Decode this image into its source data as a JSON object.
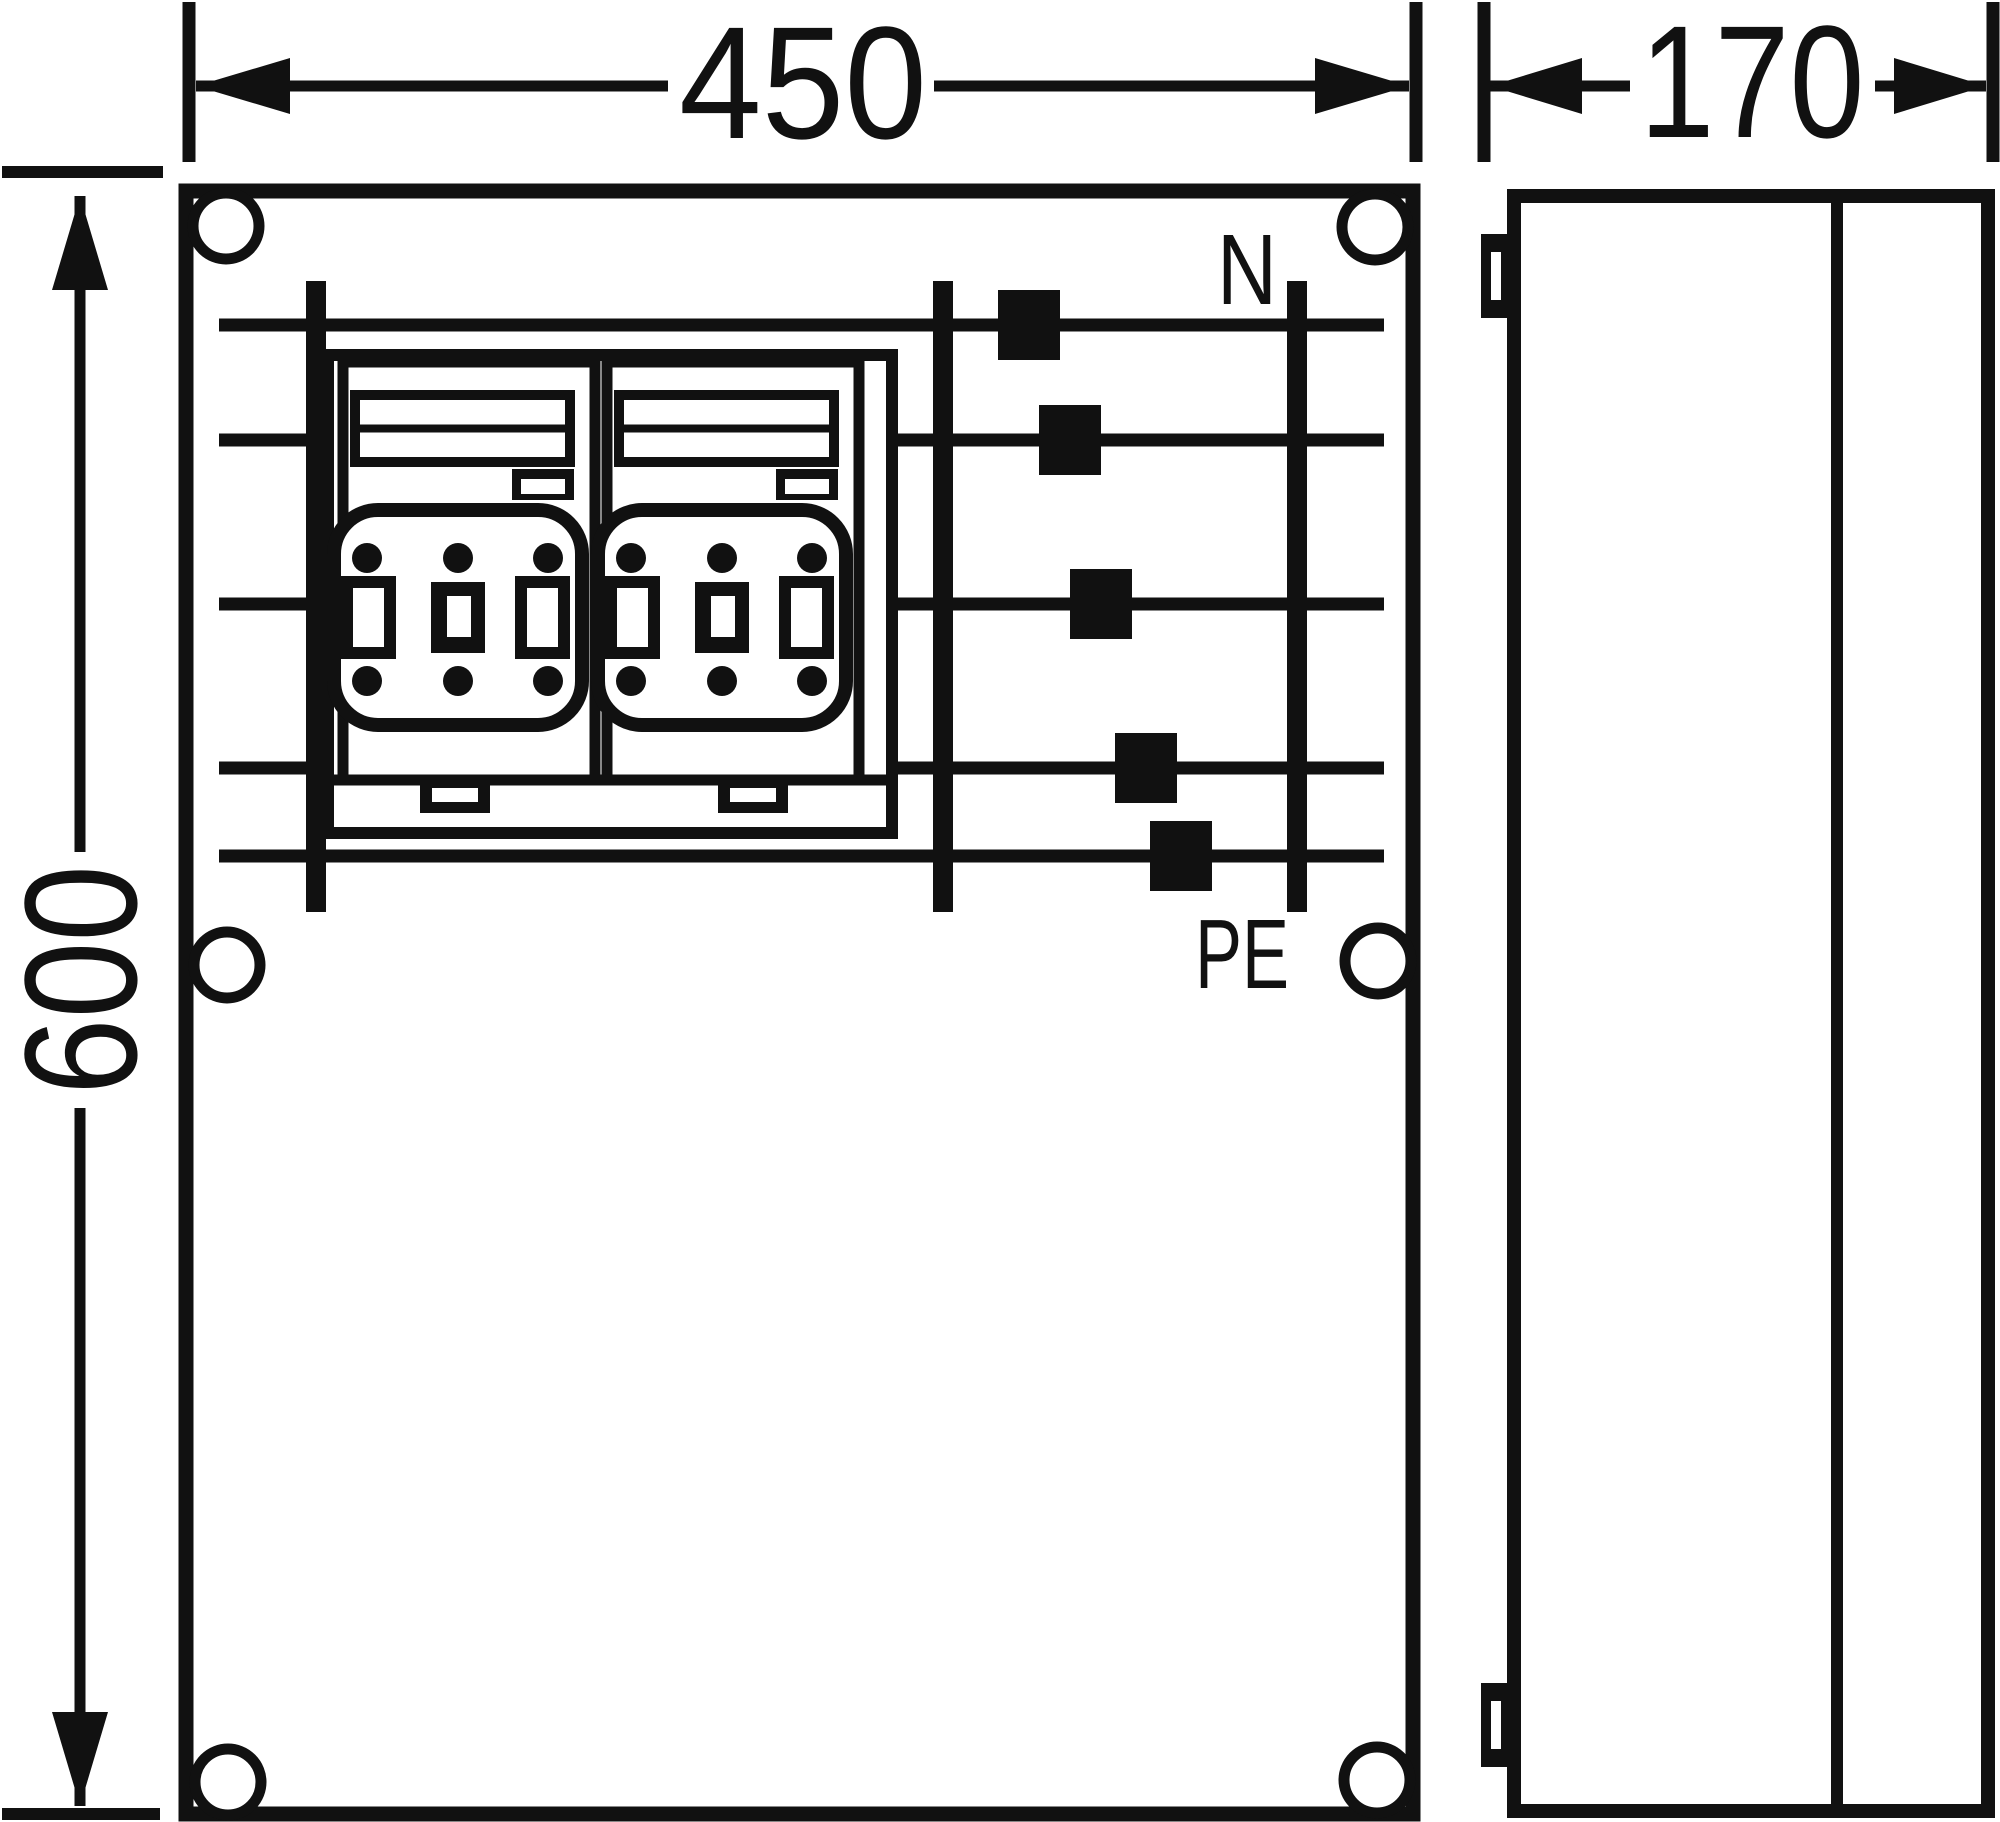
{
  "colors": {
    "ink": "#111111",
    "paper": "#ffffff"
  },
  "dimensions": {
    "front_width": "450",
    "side_depth": "170",
    "front_height": "600"
  },
  "labels": {
    "neutral": "N",
    "protective_earth": "PE"
  },
  "busbar": {
    "x_start": 219,
    "x_end": 1384,
    "verticals": [
      316,
      943,
      1297
    ],
    "vertical_y_top": 281,
    "vertical_y_bottom": 912,
    "row_stroke": 13,
    "vertical_stroke": 20,
    "tap_width": 62,
    "tap_height": 70,
    "rows": [
      {
        "y": 325,
        "tap_x": 1029
      },
      {
        "y": 440,
        "tap_x": 1070
      },
      {
        "y": 604,
        "tap_x": 1101
      },
      {
        "y": 768,
        "tap_x": 1146
      },
      {
        "y": 856,
        "tap_x": 1181
      }
    ]
  }
}
